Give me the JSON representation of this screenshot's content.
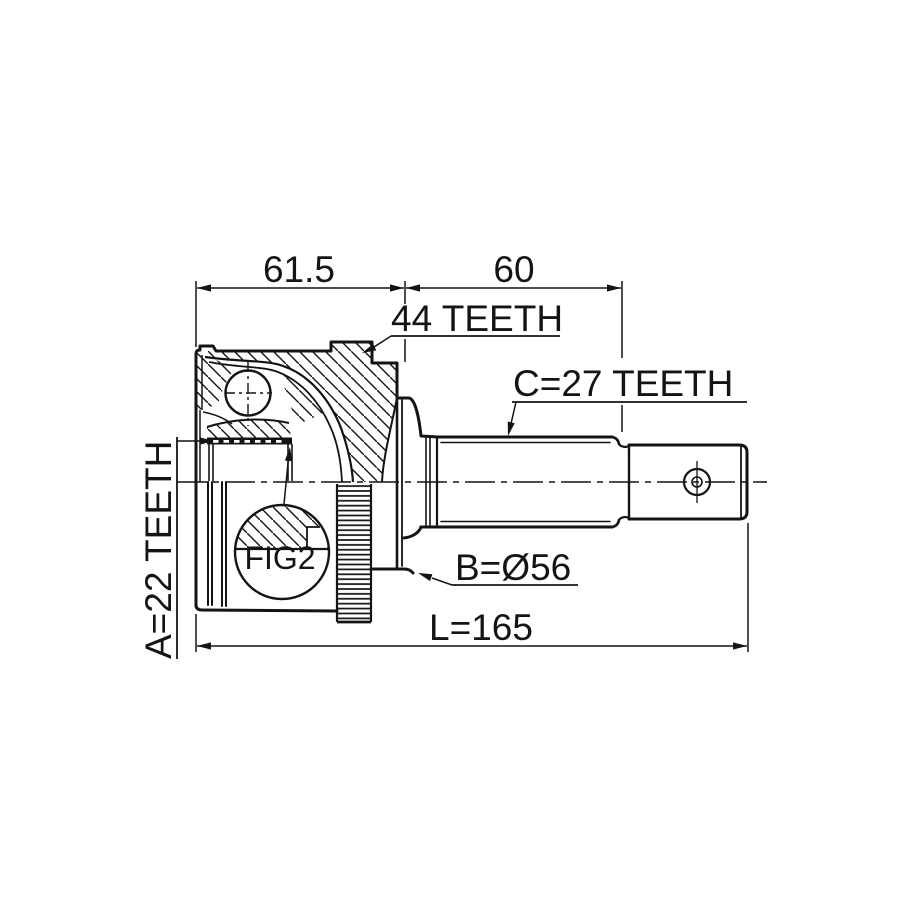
{
  "drawing": {
    "type": "technical-drawing",
    "subject": "CV joint outer assembly with ABS tone ring - side section view",
    "background_color": "#ffffff",
    "line_color": "#141414",
    "dimensions": {
      "top_left_length": "61.5",
      "top_right_length": "60",
      "overall_length": "L=165"
    },
    "callouts": {
      "abs_ring_teeth": "44 TEETH",
      "shaft_spline_teeth": "C=27 TEETH",
      "inner_race_spline_teeth": "A=22 TEETH",
      "body_diameter": "B=Ø56",
      "detail_reference": "FIG2"
    }
  }
}
